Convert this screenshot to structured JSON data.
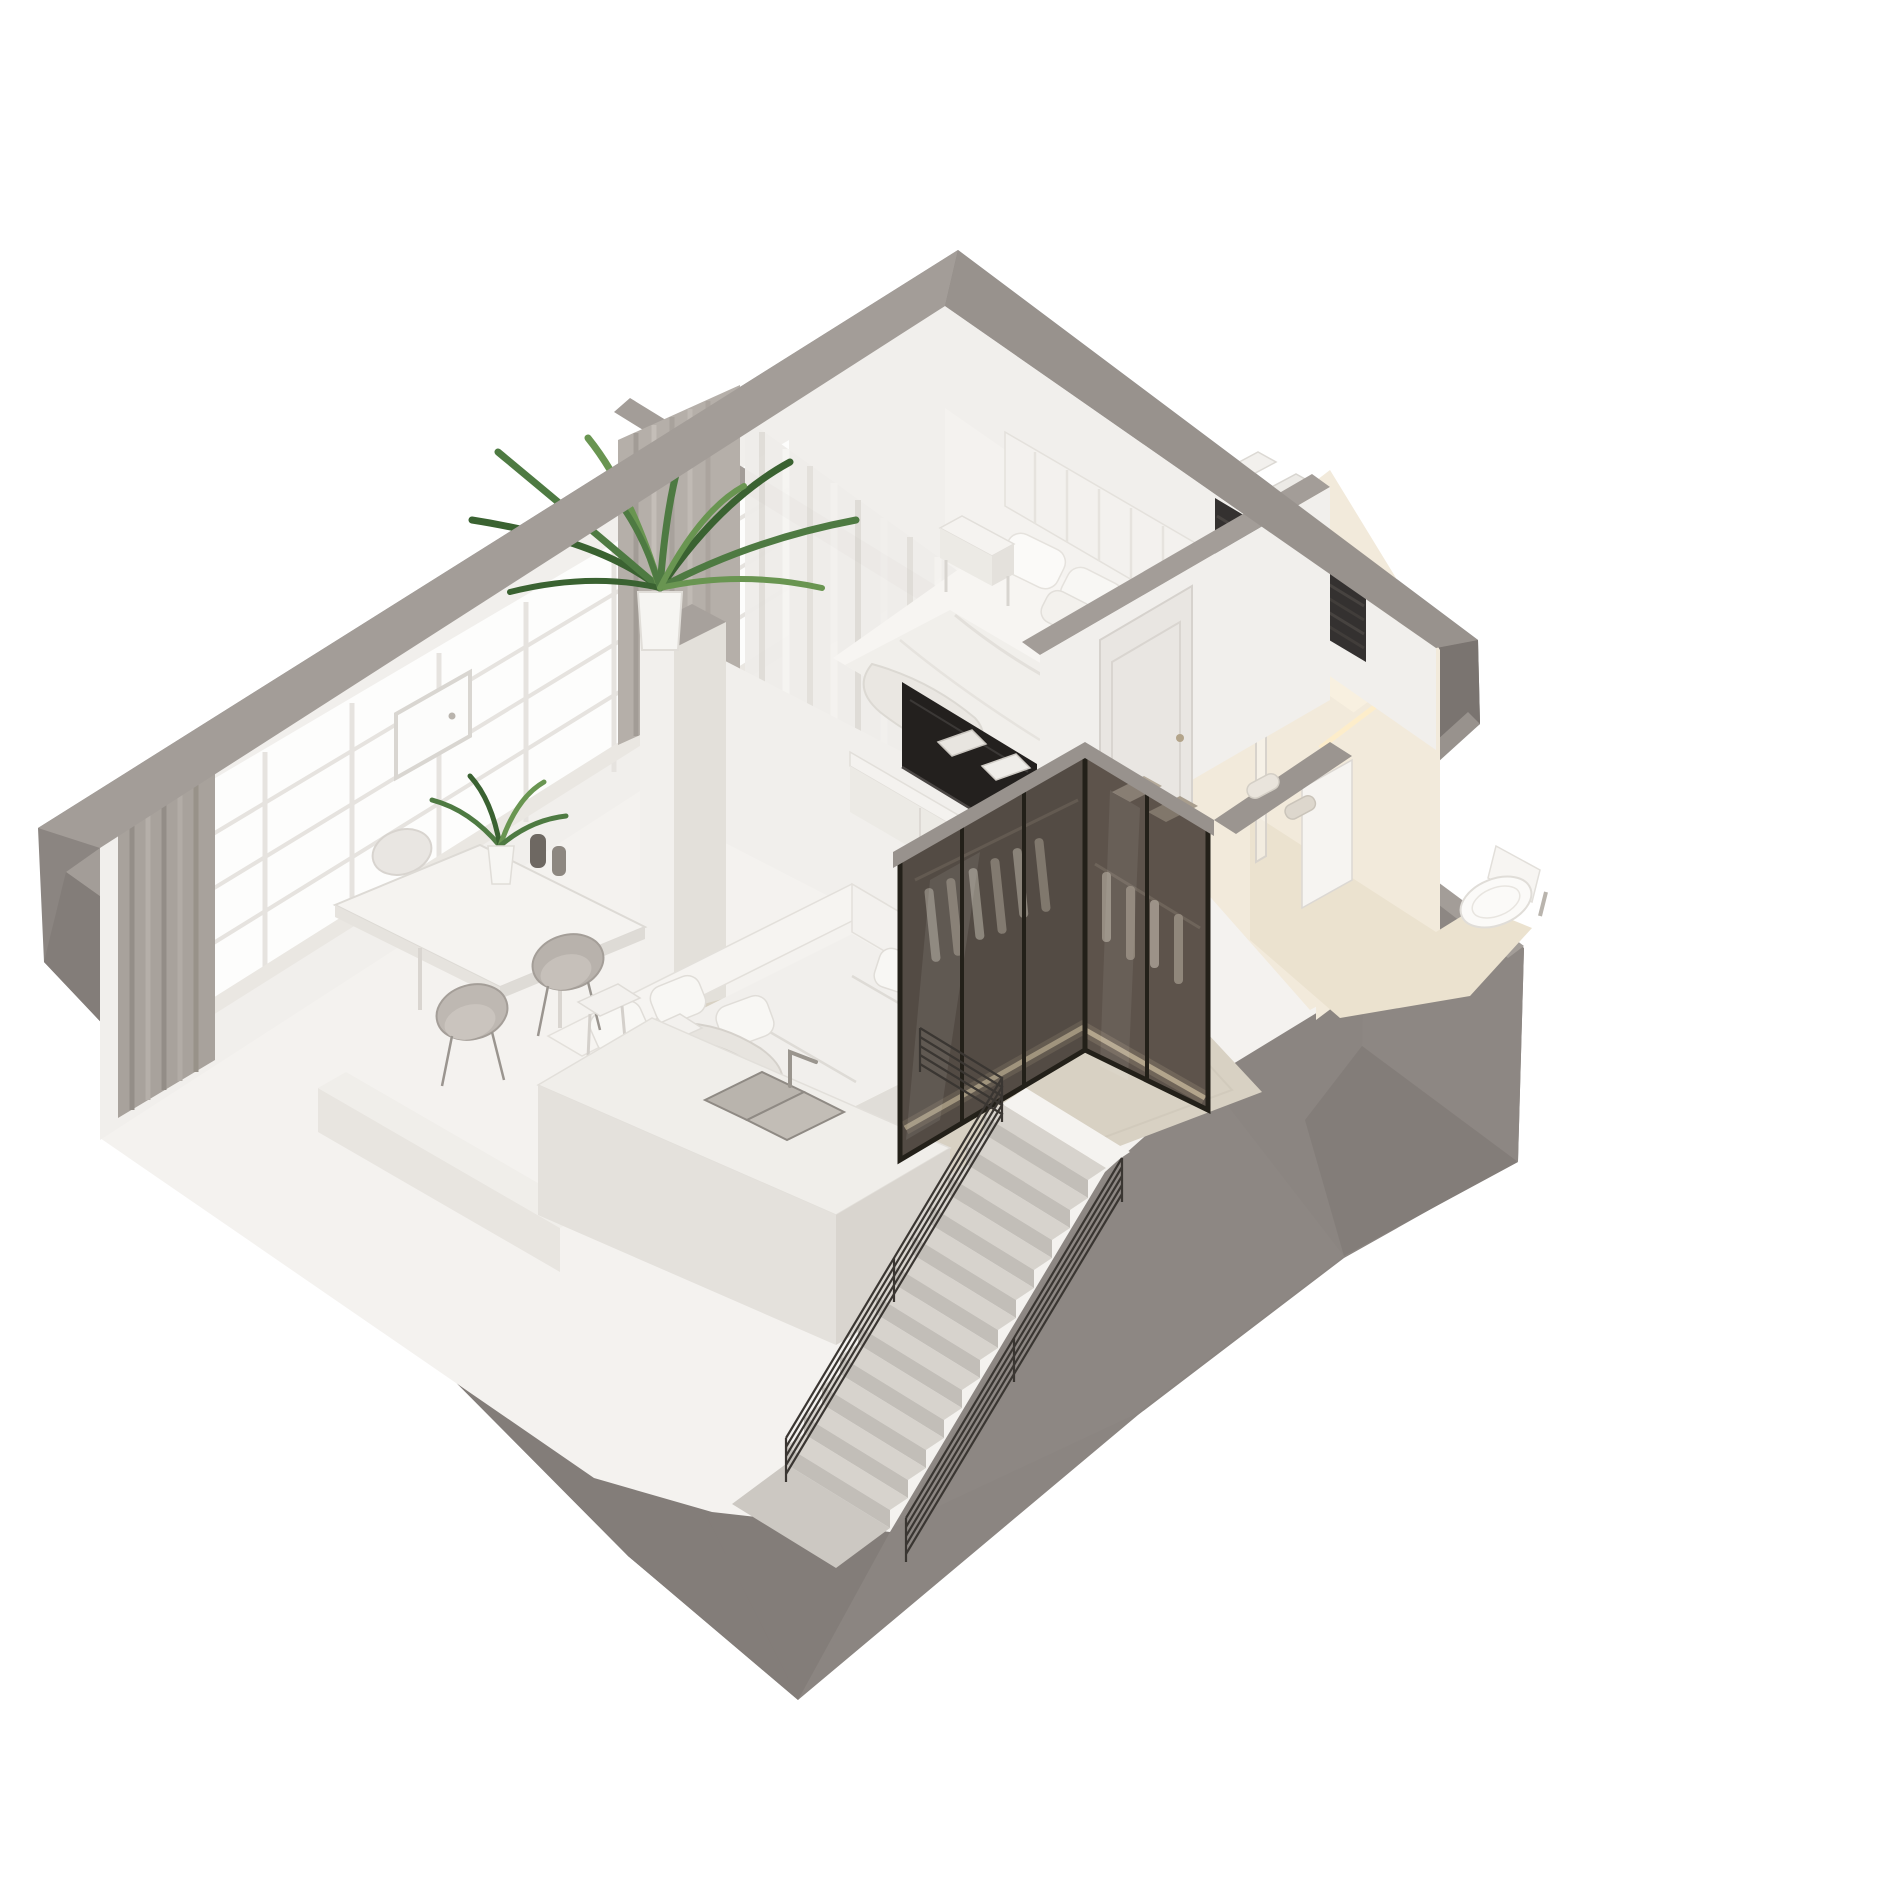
{
  "meta": {
    "kind": "3d-isometric-cutaway-floor-plan-render",
    "background": "#ffffff",
    "view": "axonometric top-down, apartment rotated 45 degrees, walls cut at one level"
  },
  "palette": {
    "bg": "#ffffff",
    "shell": "#8b8581",
    "wall-top": "#a39d98",
    "wall-top-dim": "#98928d",
    "wall-face": "#8d8783",
    "wall-face-dark": "#837d79",
    "wall-face-darker": "#7a7470",
    "interior-white": "#f4f2ef",
    "wall-white": "#f1efec",
    "floor": "#f5f3f0",
    "rug": "#d8d1c3",
    "sofa": "#f1efec",
    "sofa-shadow": "#e0ddd8",
    "cushion": "#f8f7f4",
    "tv": "#23201e",
    "bath-wall": "#f2eadb",
    "bath-wall-bright": "#f8f0e0",
    "bath-floor": "#ebe2cf",
    "led": "#ffeec9",
    "glass-tint": "rgba(52,46,42,0.45)",
    "glass-tint2": "rgba(66,58,52,0.38)",
    "frame-black": "#232019",
    "stair-tread": "#d7d3cd",
    "stair-riser": "#c2beb8",
    "landing": "#ccc8c2",
    "railing": "#3a3632",
    "mullion": "#e6e3df",
    "window-glow": "#fdfdfc",
    "plant": "#4e7a42",
    "plant-dark": "#3a6231",
    "plant-light": "#699551",
    "steel": "#b9b4ad",
    "dark-closet": "#343130",
    "curtain-gray": "#a8a29c",
    "curtain-sheer": "#efedea"
  },
  "scene": {
    "rooms": [
      {
        "name": "bedroom",
        "position": "top",
        "objects": [
          "double-bed",
          "channel-tufted-headboard",
          "pillows",
          "duvet",
          "nightstand",
          "sheer-curtains",
          "dark-slatted-closet-niche",
          "white-door"
        ]
      },
      {
        "name": "bathroom",
        "position": "right",
        "objects": [
          "walk-in-shower",
          "square-rain-shower-head",
          "glass-screen",
          "wall-hung-toilet",
          "hand-sprayer",
          "warm-led-cove-lighting",
          "open-door"
        ]
      },
      {
        "name": "walk-in-wardrobe",
        "position": "center-right",
        "objects": [
          "smoked-glass-partition",
          "black-frames",
          "hanging-clothes",
          "storage-boxes",
          "warm-led-floor-strip"
        ]
      },
      {
        "name": "living-room",
        "position": "center-left",
        "objects": [
          "l-shaped-white-sofa",
          "throw-blanket",
          "pillows",
          "beige-rug",
          "wall-mounted-tv",
          "media-console",
          "palm-plant",
          "white-column",
          "gray-curtain"
        ]
      },
      {
        "name": "dining-area",
        "position": "left",
        "objects": [
          "white-table",
          "four-chairs",
          "table-plant",
          "vases"
        ]
      },
      {
        "name": "kitchen",
        "position": "bottom-left",
        "objects": [
          "island-with-double-sink",
          "faucet",
          "two-stools",
          "counter"
        ]
      },
      {
        "name": "staircase",
        "position": "bottom-center",
        "objects": [
          "straight-flight-down",
          "landing",
          "black-rod-railings",
          "gray-stairwell-walls"
        ]
      }
    ],
    "envelope": [
      "industrial-grid-window-wall-upper-left",
      "thick-gray-cut-walls",
      "exterior-bay-protrusion-right"
    ]
  }
}
